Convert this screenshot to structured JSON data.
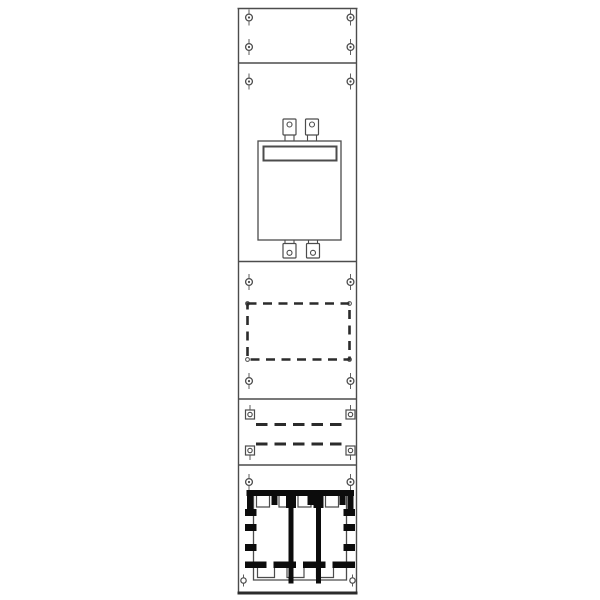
{
  "meta": {
    "title": "Distribution board panel - technical line drawing",
    "canvas": {
      "width": 600,
      "height": 600
    },
    "colors": {
      "background": "#ffffff",
      "line": "#4c4c4c",
      "dark": "#2b2b2b",
      "busbar": "#0c0c0c",
      "white": "#ffffff"
    }
  },
  "panel": {
    "left": 238.5,
    "right": 356.5,
    "top": 8.5,
    "bottom": 592,
    "divider_lines_y": [
      63,
      261.5,
      399,
      465
    ],
    "bottom_bar": {
      "x1": 237.5,
      "x2": 357.5,
      "y": 591.5,
      "height": 3
    }
  },
  "screws": {
    "left_x": 249,
    "right_x": 350.5,
    "plain_rows_y": [
      17.5,
      47,
      81.5,
      282,
      381,
      482
    ],
    "square_rows": [
      {
        "y": 414.5,
        "pin": "up"
      },
      {
        "y": 450.5,
        "pin": "down"
      }
    ]
  },
  "meter_field": {
    "plate": {
      "x": 258,
      "y": 141,
      "width": 83,
      "height": 99
    },
    "label_window": {
      "x": 263.5,
      "y": 146.5,
      "width": 73,
      "height": 14
    },
    "clips_top": {
      "y": 119,
      "height": 16,
      "width": 13,
      "centers_x": [
        289.5,
        312
      ],
      "leg_to": 141
    },
    "clips_bottom": {
      "y": 243.5,
      "height": 14.5,
      "width": 13,
      "centers_x": [
        289.5,
        313
      ],
      "leg_to": 240
    }
  },
  "reserved_field": {
    "rect": {
      "x": 247.5,
      "y": 303.5,
      "width": 102,
      "height": 56
    },
    "dash": "9 6.5",
    "stroke_width": 2.6,
    "corner_screw_r": 1.9
  },
  "terminal_field": {
    "dash": "11.5 7",
    "stroke_width": 3,
    "dashed_lines": [
      {
        "y": 424.5,
        "x1": 256,
        "x2": 344
      },
      {
        "y": 444,
        "x1": 256,
        "x2": 344
      }
    ]
  },
  "busbar_field": {
    "top_bar": {
      "x": 246.5,
      "y": 490,
      "width": 107.5,
      "height": 6
    },
    "body": {
      "x": 253.5,
      "y": 496,
      "x2": 346.5,
      "bottom": 580
    },
    "vertical_bars": {
      "centers_x": [
        291,
        318.5
      ],
      "width": 5,
      "y1": 490.5,
      "y2": 583.5
    },
    "end_stubs": [
      {
        "x": 247,
        "width": 6,
        "height": 13
      },
      {
        "x": 347.5,
        "width": 6,
        "height": 13
      }
    ],
    "top_stubs": {
      "height": 9,
      "width": 6,
      "xs": [
        271.5,
        307.5,
        339.5
      ]
    },
    "collars": {
      "height": 12,
      "width": 10,
      "xs": [
        286,
        313.5
      ]
    },
    "top_notches": {
      "y": 496,
      "height": 11,
      "items": [
        {
          "x": 256.5,
          "width": 13
        },
        {
          "x": 279,
          "width": 9
        },
        {
          "x": 298,
          "width": 13
        },
        {
          "x": 325.5,
          "width": 13
        }
      ]
    },
    "side_teeth": {
      "left_x": 245,
      "right_x": 343.5,
      "width": 11.5,
      "height": 7,
      "ys": [
        509,
        524,
        544
      ]
    },
    "bottom_row": {
      "y": 561.5,
      "height": 6.5,
      "segments": [
        [
          245,
          266.5
        ],
        [
          273.5,
          296
        ],
        [
          303,
          325.5
        ],
        [
          332.5,
          355
        ]
      ]
    },
    "bottom_notches": {
      "y": 567,
      "height": 10.5,
      "width": 17,
      "xs": [
        257.5,
        287,
        316.5
      ]
    },
    "bottom_screws": {
      "y": 580.5,
      "r": 2.7,
      "xs": [
        243.5,
        352.5
      ]
    }
  }
}
